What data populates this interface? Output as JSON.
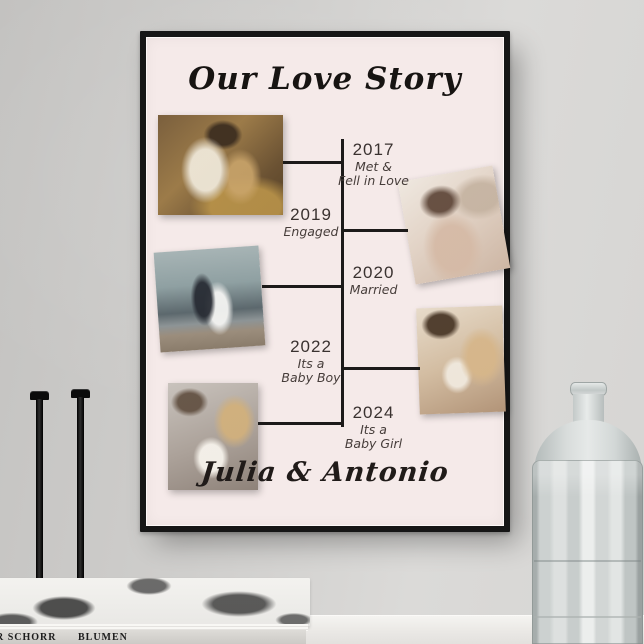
{
  "poster": {
    "title": "Our Love Story",
    "couple_names": "Julia & Antonio",
    "colors": {
      "poster_bg": "#f5eae9",
      "frame": "#161616",
      "timeline_line": "#1c1a19",
      "text": "#3a3230"
    },
    "timeline": [
      {
        "year": "2017",
        "caption_line1": "Met &",
        "caption_line2": "Fell in Love"
      },
      {
        "year": "2019",
        "caption_line1": "Engaged",
        "caption_line2": ""
      },
      {
        "year": "2020",
        "caption_line1": "Married",
        "caption_line2": ""
      },
      {
        "year": "2022",
        "caption_line1": "Its a",
        "caption_line2": "Baby Boy"
      },
      {
        "year": "2024",
        "caption_line1": "Its a",
        "caption_line2": "Baby Girl"
      }
    ],
    "photos": [
      {
        "name": "photo-2017",
        "desc": "couple kissing among autumn leaves"
      },
      {
        "name": "photo-2019",
        "desc": "bride laughing showing engagement ring"
      },
      {
        "name": "photo-2020",
        "desc": "wedding couple on mountain lake pier"
      },
      {
        "name": "photo-2022",
        "desc": "parents kissing while holding baby"
      },
      {
        "name": "photo-2024",
        "desc": "parents cradling newborn in white wrap"
      }
    ]
  },
  "props": {
    "book_spine_text_left": "R SCHORR",
    "book_spine_text_right": "BLUMEN"
  }
}
